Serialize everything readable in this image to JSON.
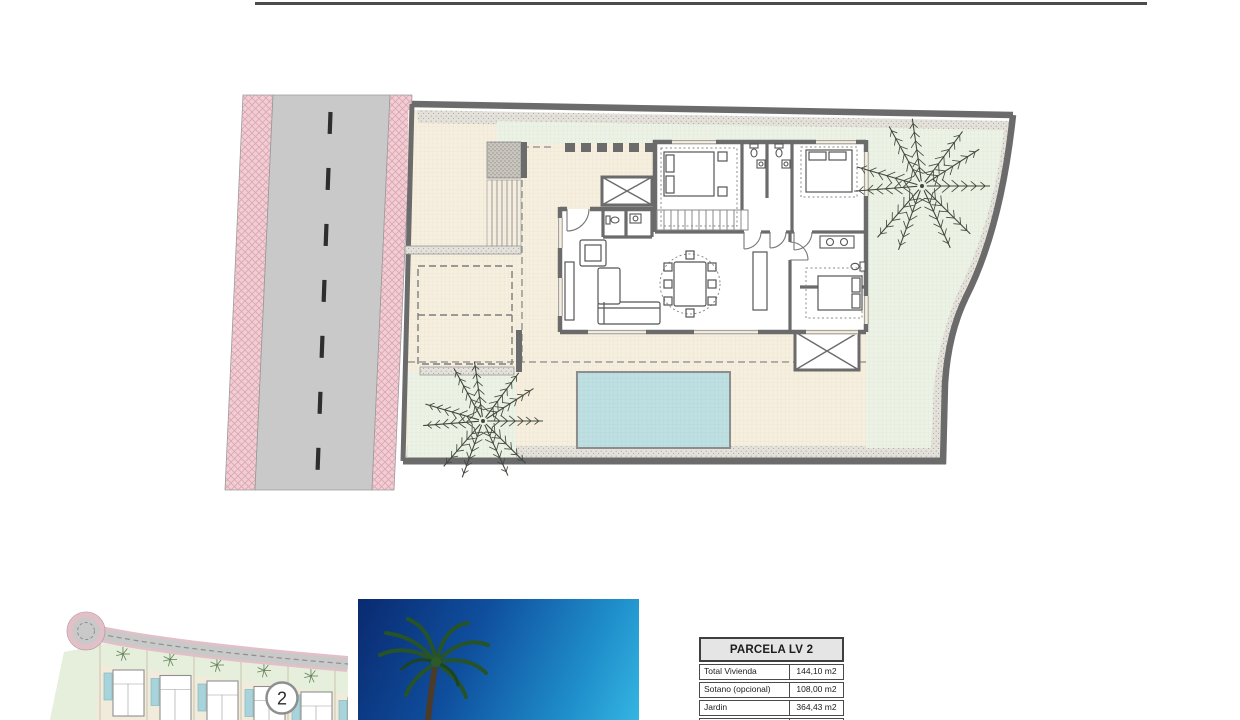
{
  "plan": {
    "plot_marker": "2"
  },
  "table": {
    "title": "PARCELA LV 2",
    "rows": [
      {
        "label": "Total Vivienda",
        "value": "144,10 m2"
      },
      {
        "label": "Sotano (opcional)",
        "value": "108,00 m2"
      },
      {
        "label": "Jardin",
        "value": "364,43 m2"
      }
    ]
  },
  "colors": {
    "header_rule": "#4c4c4c",
    "road_asphalt": "#c9c9c9",
    "sidewalk_pink": "#f2cdd3",
    "terrace_cream": "#f6efdf",
    "garden_green": "#ecf2e6",
    "pool_blue": "#bfe0e2",
    "wall_gray": "#6b6b6b",
    "sky_top": "#0a2a70",
    "sky_bottom": "#35b5e2",
    "table_header_bg": "#e5e5e5"
  }
}
